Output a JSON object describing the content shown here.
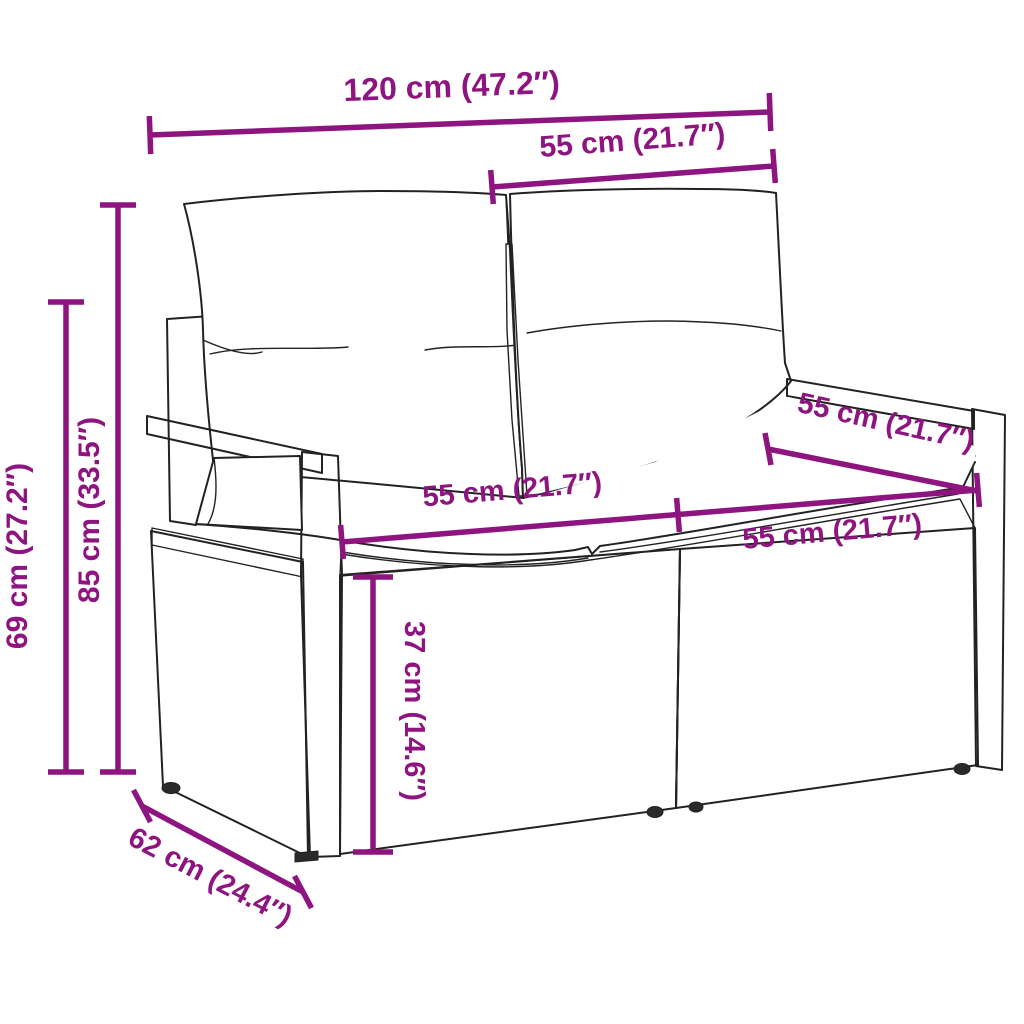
{
  "title": "Garden loveseat sofa dimension diagram",
  "colors": {
    "accent": "#8E1480",
    "line": "#222222",
    "background": "#FFFFFF"
  },
  "dimensions": {
    "total_width": {
      "label": "120 cm (47.2″)"
    },
    "backrest_width": {
      "label": "55 cm (21.7″)"
    },
    "total_height": {
      "label": "85 cm (33.5″)"
    },
    "armrest_height": {
      "label": "69 cm (27.2″)"
    },
    "seat_width_left": {
      "label": "55 cm (21.7″)"
    },
    "seat_width_right": {
      "label": "55 cm (21.7″)"
    },
    "seat_depth_back": {
      "label": "55 cm (21.7″)"
    },
    "seat_height": {
      "label": "37 cm (14.6″)"
    },
    "total_depth": {
      "label": "62 cm (24.4″)"
    }
  }
}
